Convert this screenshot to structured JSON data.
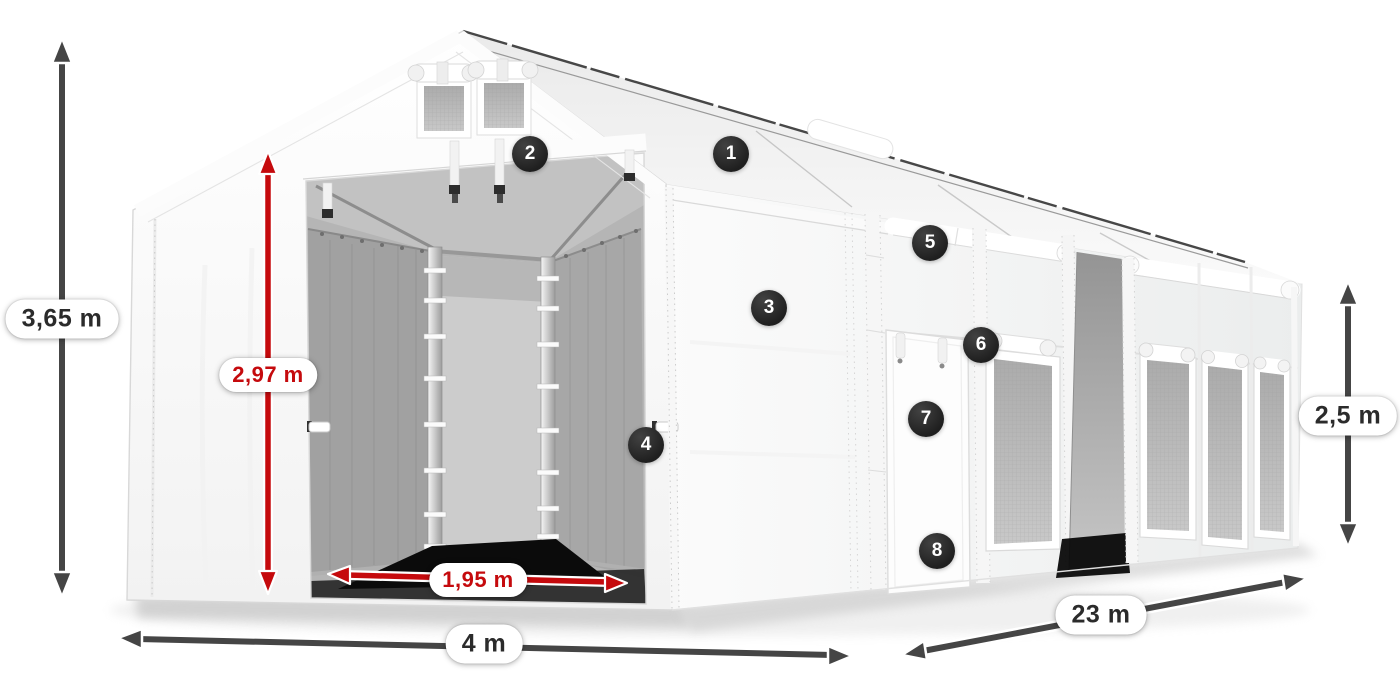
{
  "dimensions": {
    "total_height": {
      "label": "3,65 m",
      "color": "dark"
    },
    "entrance_height": {
      "label": "2,97 m",
      "color": "red"
    },
    "entrance_width": {
      "label": "1,95 m",
      "color": "red"
    },
    "width": {
      "label": "4 m",
      "color": "dark"
    },
    "length": {
      "label": "23 m",
      "color": "dark"
    },
    "side_height": {
      "label": "2,5 m",
      "color": "dark"
    }
  },
  "callouts": [
    {
      "number": "1"
    },
    {
      "number": "2"
    },
    {
      "number": "3"
    },
    {
      "number": "4"
    },
    {
      "number": "5"
    },
    {
      "number": "6"
    },
    {
      "number": "7"
    },
    {
      "number": "8"
    }
  ],
  "colors": {
    "dimension_dark": "#454545",
    "dimension_red": "#c50a0d",
    "badge_background": "#1f1f1f",
    "badge_text": "#ffffff",
    "label_background": "#ffffff",
    "label_text": "#2b2b2b"
  }
}
